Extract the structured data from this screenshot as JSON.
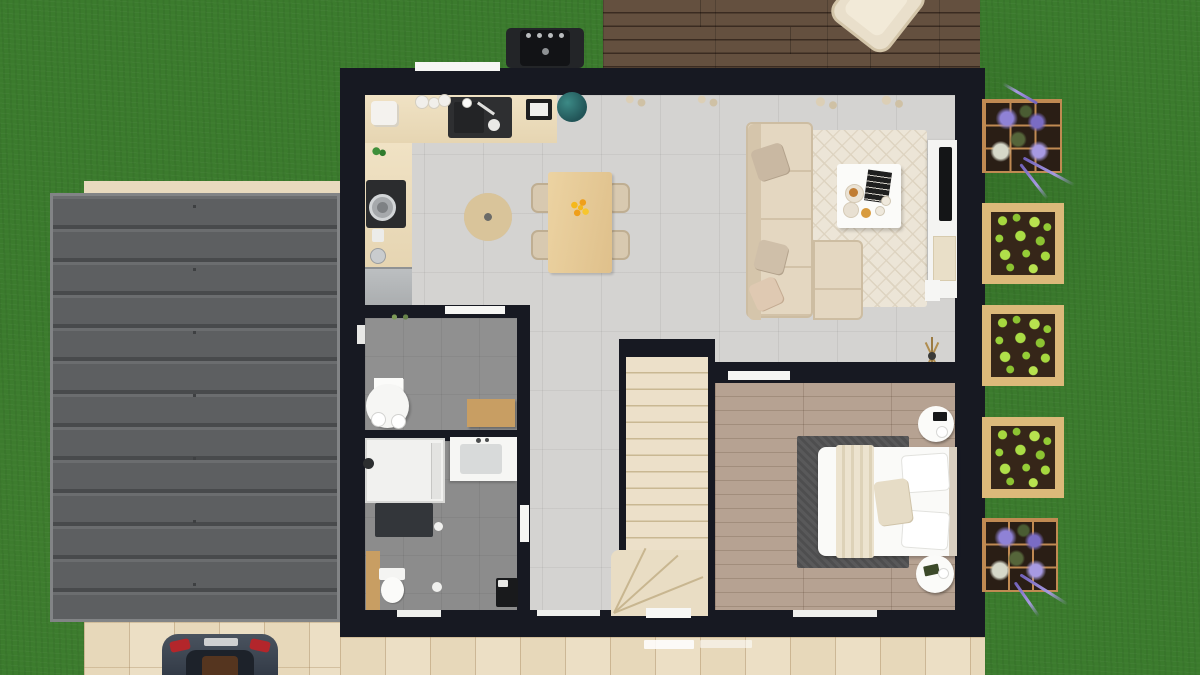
{
  "scene": {
    "description": "3D architectural floor plan, top-down view, single-storey house with garage, rear deck, driveway with car and vegetable garden",
    "view": "top-down render",
    "visible_text": ""
  },
  "colors": {
    "grass": "#3b7b2d",
    "wall": "#171922",
    "floor-main": "#d4d3d1",
    "floor-gray": "#909090",
    "tile": "#ecdfc5",
    "wood": "#c89e63",
    "roof": "#5d5f61",
    "deck-wood": "#5d4a3a",
    "bedroom-floor": "#b4a08f",
    "car-body": "#3a4350",
    "planter-frame": "#dcb97a",
    "lavender": "#8f82d6",
    "lettuce": "#a6d83f",
    "accent-flowers": "#f2b01c"
  },
  "house": {
    "rooms": [
      {
        "name": "kitchen",
        "floor": "light gray tile",
        "furniture": [
          "L-shaped counter",
          "sink with faucet",
          "cooktop with pot",
          "coffee machine",
          "cutting board",
          "fridge",
          "plant",
          "globe decor"
        ]
      },
      {
        "name": "dining area",
        "furniture": [
          "wood dining table",
          "4 beige chairs",
          "round jute rug",
          "yellow flower centerpiece",
          "pendant light"
        ]
      },
      {
        "name": "living room",
        "furniture": [
          "beige L-shaped sofa",
          "3 throw pillows",
          "cream diamond-pattern rug",
          "white coffee table",
          "black book",
          "plates with pastries",
          "TV console",
          "flat TV",
          "tripod floor lamp"
        ]
      },
      {
        "name": "office",
        "floor": "gray",
        "furniture": [
          "white desk",
          "white swivel chair",
          "wall shelf"
        ]
      },
      {
        "name": "bathroom",
        "floor": "gray",
        "furniture": [
          "walk-in shower",
          "vanity sink",
          "toilet",
          "dark bath mat",
          "laundry basket",
          "wood cabinet"
        ]
      },
      {
        "name": "hallway",
        "floor": "light gray tile"
      },
      {
        "name": "staircase",
        "furniture": [
          "straight run treads",
          "winder steps"
        ]
      },
      {
        "name": "bedroom",
        "floor": "wood planks",
        "furniture": [
          "double bed with white duvet",
          "beige throw blanket",
          "2 white pillows",
          "beige cushion",
          "dark gray rug",
          "2 round nightstands",
          "alarm clock"
        ]
      }
    ],
    "openings": [
      "kitchen window top wall",
      "office window left wall",
      "office door",
      "bathroom door",
      "bedroom door",
      "entry door bottom wall",
      "bathroom window",
      "hallway window",
      "bedroom window"
    ]
  },
  "exterior": {
    "garage_roof": {
      "panels": 13,
      "material": "dark metal sheets"
    },
    "deck": {
      "material": "walnut planks",
      "furniture": [
        "lounge chair",
        "bbq grill"
      ]
    },
    "driveway": {
      "vehicles": [
        {
          "type": "car",
          "color": "dark gray",
          "orientation": "front facing house"
        }
      ]
    },
    "patio": {
      "material": "beige tiles",
      "doormats": 2
    },
    "garden": {
      "planters": [
        {
          "type": "lavender grid planter"
        },
        {
          "type": "lettuce raised bed"
        },
        {
          "type": "lettuce raised bed"
        },
        {
          "type": "lettuce raised bed"
        },
        {
          "type": "lavender grid planter"
        }
      ]
    }
  }
}
